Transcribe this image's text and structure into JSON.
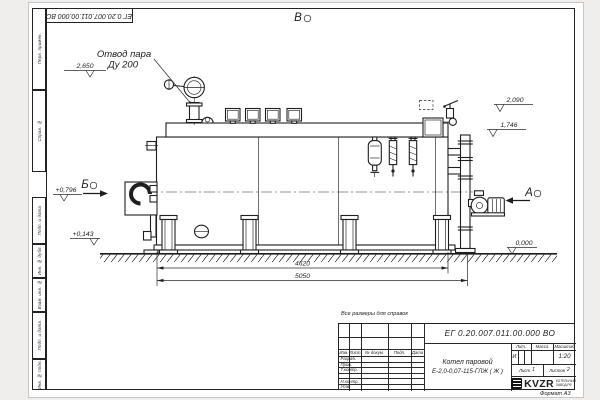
{
  "sheet": {
    "note_all_dims": "Все размеры для справок",
    "format_label": "Формат А3",
    "frame_labels": {
      "perv_primen": "Перв. примен.",
      "sprav_no": "Справ. №",
      "podp_data_1": "Подп. и дата",
      "inv_dubl": "Инв. № дубл.",
      "vzam_inv": "Взам. инв. №",
      "podp_data_2": "Подп. и дата",
      "inv_podl": "Инв. № подл."
    }
  },
  "title_block": {
    "doc_number": "ЕГ 0.20.007.011.00.000  ВО",
    "product_line1": "Котел паровой",
    "product_line2": "Е-2,0-0,07-115-ГЛЖ ( Ж )",
    "header_cols": {
      "izm": "Изм.",
      "list": "Лист",
      "docum": "№ докум.",
      "podp": "Подп.",
      "data": "Дата"
    },
    "row_labels": {
      "razrab": "Разраб.",
      "prov": "Пров.",
      "tkontr": "Т.контр.",
      "nkontr": "Н.контр.",
      "utv": "Утв."
    },
    "lit_label": "Лит.",
    "lit_value": "И",
    "mass_label": "Масса",
    "scale_label": "Масштаб",
    "scale_value": "1:20",
    "sheet_label": "Лист",
    "sheet_value": "1",
    "sheets_label": "Листов",
    "sheets_value": "2",
    "logo": {
      "text": "KVZR",
      "sub1": "КОТЕЛЬНЫЙ",
      "sub2": "ЗАВОД.РФ"
    }
  },
  "drawing": {
    "callout_steam": {
      "line1": "Отвод пара",
      "line2": "Ду 200"
    },
    "view_top": "В",
    "view_left": "Б",
    "view_right": "А",
    "elev_2650": "2,650",
    "elev_0796": "+0,796",
    "elev_0143": "+0,143",
    "elev_2090": "2,090",
    "elev_1746": "1,746",
    "elev_0000": "0,000",
    "dim_length_inner": "4620",
    "dim_length_total": "5050"
  }
}
